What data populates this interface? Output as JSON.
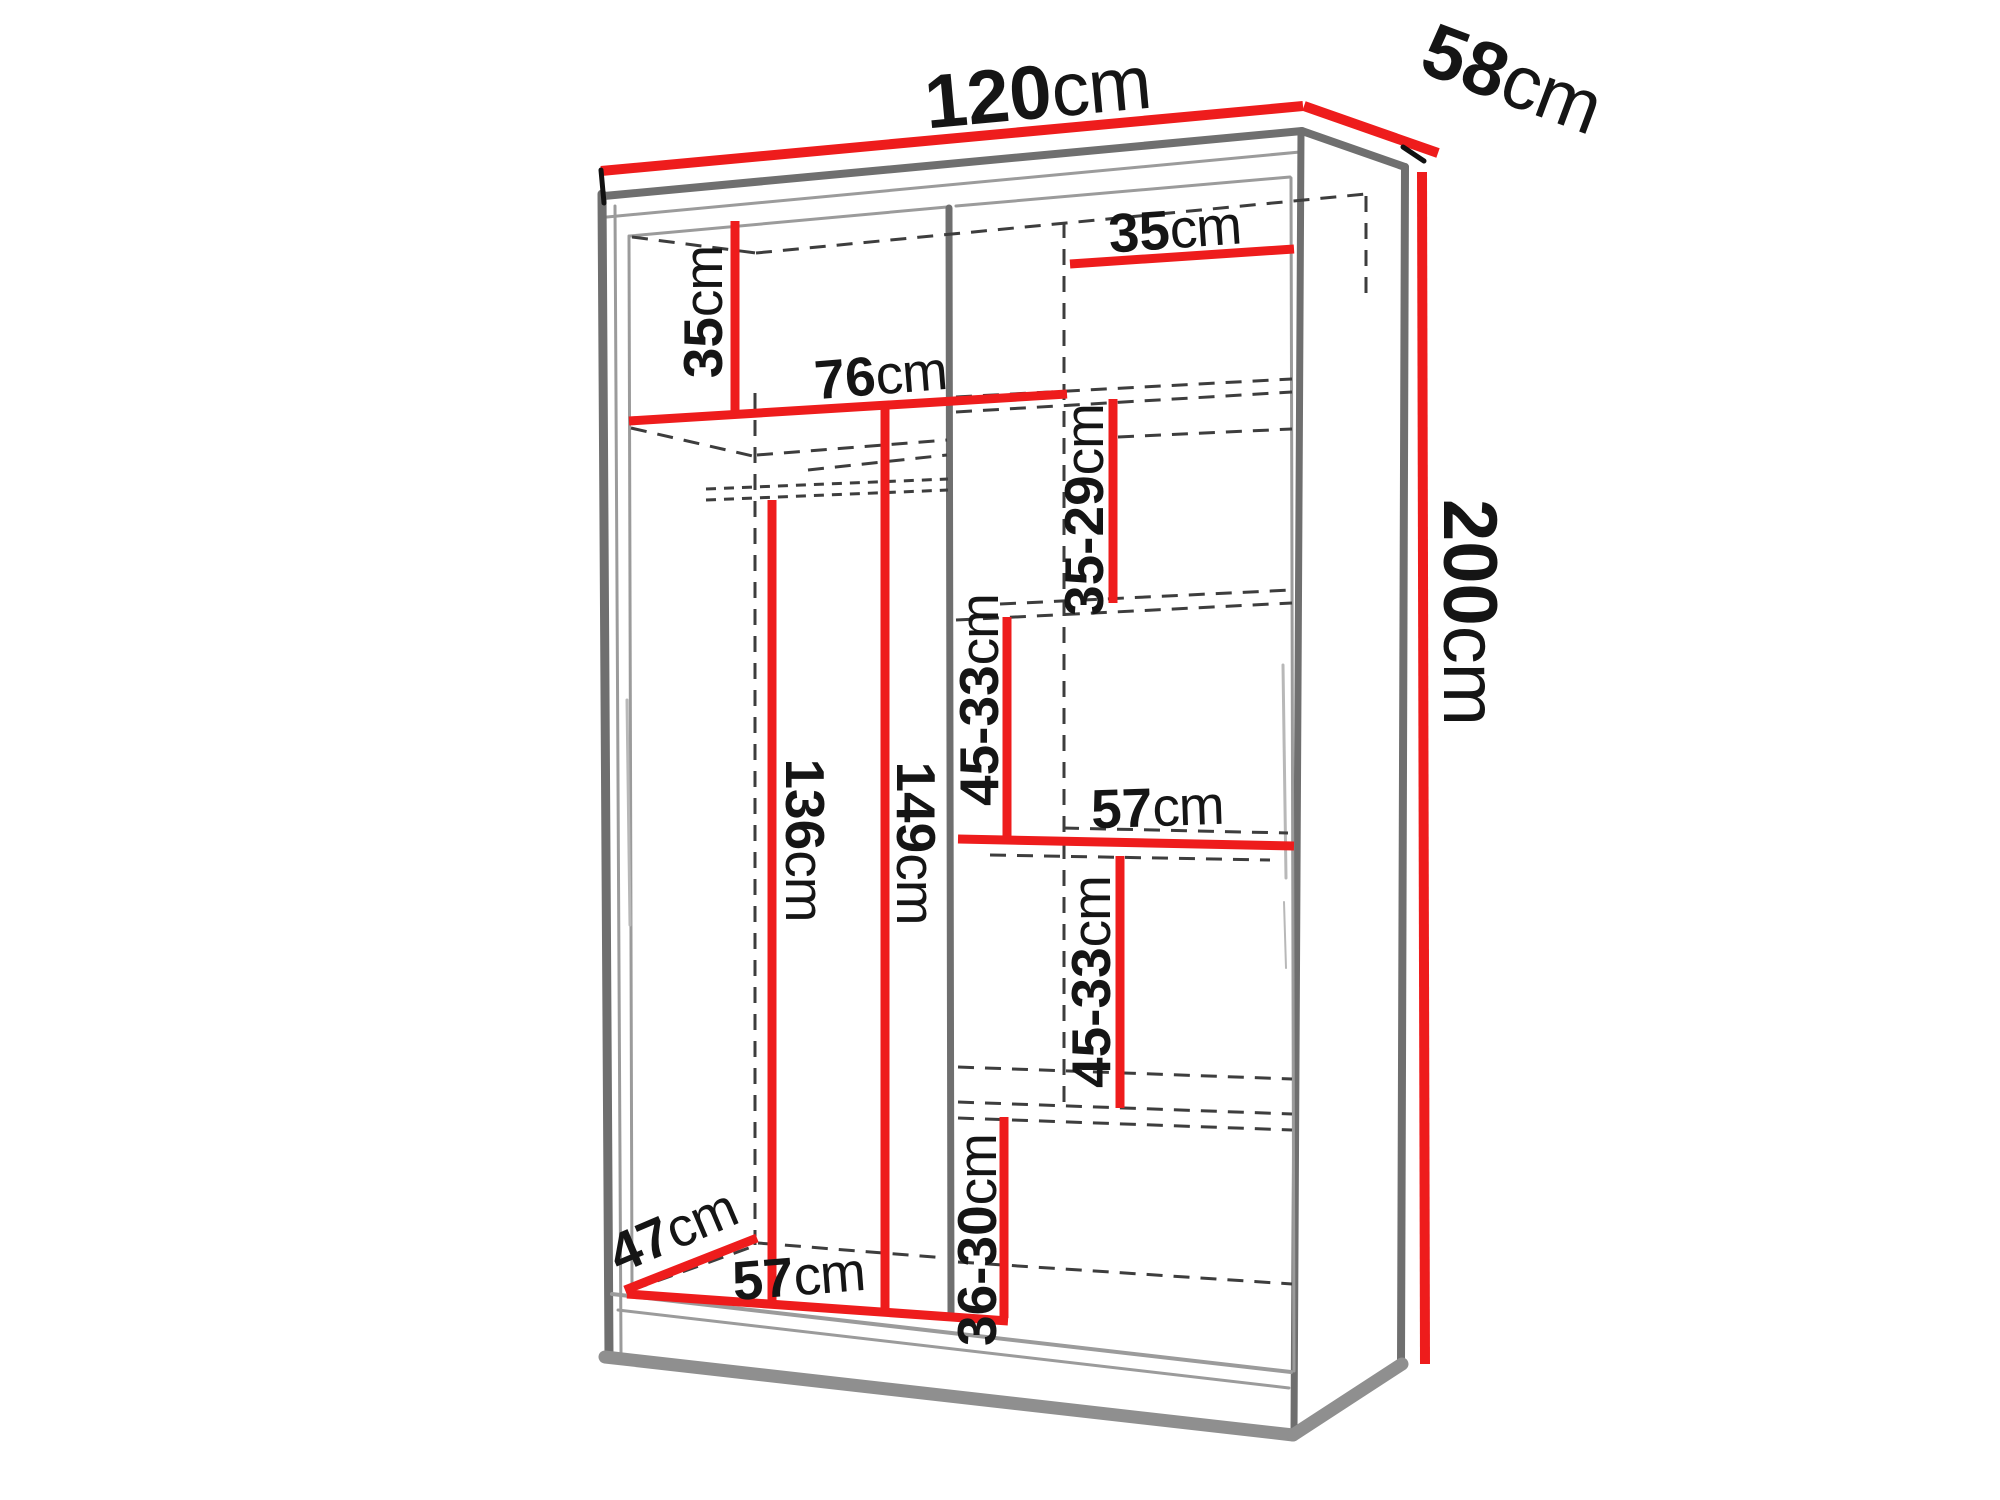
{
  "accent_color": "#ee1c1c",
  "diagram": {
    "name": "Wardrobe dimension diagram",
    "labels": [
      {
        "id": "overall-width",
        "value": "120",
        "unit": "cm"
      },
      {
        "id": "overall-depth",
        "value": "58",
        "unit": "cm"
      },
      {
        "id": "overall-height",
        "value": "200",
        "unit": "cm"
      },
      {
        "id": "left-top-section",
        "value": "35",
        "unit": "cm"
      },
      {
        "id": "hanging-area-width",
        "value": "76",
        "unit": "cm"
      },
      {
        "id": "right-top-shelf",
        "value": "35",
        "unit": "cm"
      },
      {
        "id": "right-gap-1",
        "value": "35-29",
        "unit": "cm"
      },
      {
        "id": "right-gap-2",
        "value": "45-33",
        "unit": "cm"
      },
      {
        "id": "right-shelf-width",
        "value": "57",
        "unit": "cm"
      },
      {
        "id": "right-gap-3",
        "value": "45-33",
        "unit": "cm"
      },
      {
        "id": "hanging-height",
        "value": "136",
        "unit": "cm"
      },
      {
        "id": "left-section-height",
        "value": "149",
        "unit": "cm"
      },
      {
        "id": "right-gap-4",
        "value": "36-30",
        "unit": "cm"
      },
      {
        "id": "bottom-depth",
        "value": "47",
        "unit": "cm"
      },
      {
        "id": "left-section-width",
        "value": "57",
        "unit": "cm"
      }
    ]
  }
}
